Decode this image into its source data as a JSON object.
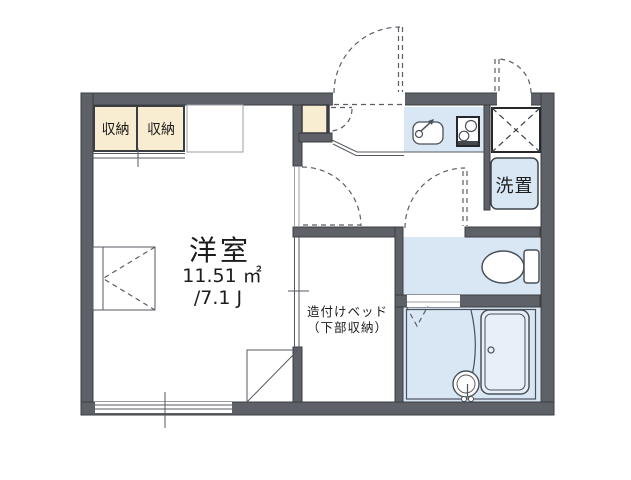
{
  "colors": {
    "wall": "#5e6167",
    "wall_outline": "#3a3d42",
    "closet_fill": "#f8ecd1",
    "wet_area_fill": "#d9e7f5",
    "tub_fill": "#e7eff9",
    "text": "#1c1c1c"
  },
  "labels": {
    "closet_left": "収納",
    "closet_right": "収納",
    "washer": "洗置",
    "bed_line1": "造付けベッド",
    "bed_line2": "（下部収納）"
  },
  "room": {
    "name": "洋室",
    "area_m2": "11.51 ㎡",
    "area_jo": "/7.1 J"
  }
}
